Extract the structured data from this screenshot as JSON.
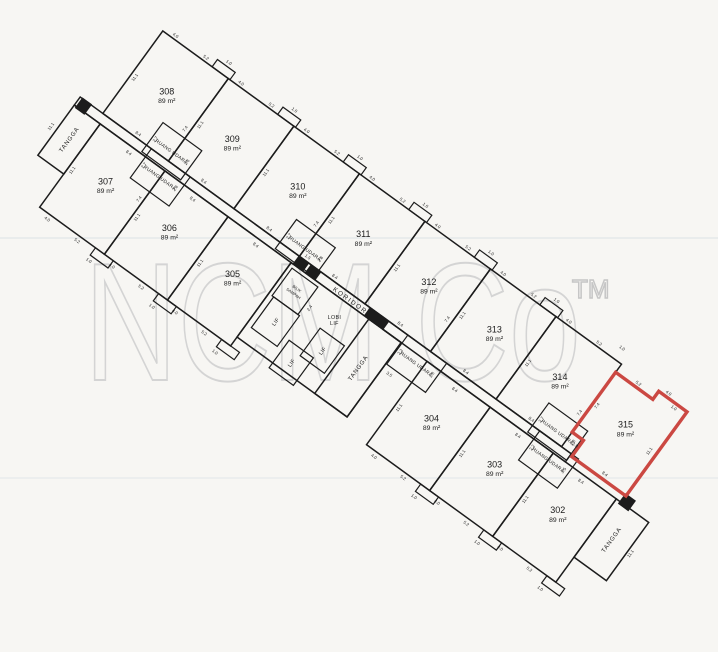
{
  "watermark": {
    "text": "NCM Co",
    "tm": "TM"
  },
  "page": {
    "paper_color": "#f7f6f3",
    "ink_color": "#1c1c1c",
    "highlight_color": "#cb4842",
    "watermark_color": "#d4d4d4"
  },
  "plan": {
    "angle": 36,
    "origin": {
      "x": 145,
      "y": 18
    },
    "corridor": {
      "label": "KORIDOR",
      "x": -6,
      "y": 102,
      "w": 607,
      "h": 10,
      "label_x": 332,
      "label_y": 110
    },
    "row_upper": {
      "y": 0,
      "h": 102
    },
    "row_lower": {
      "y": 112,
      "h": 103
    },
    "upper_units": [
      {
        "num": "308",
        "area": "89 m²",
        "x1": 22,
        "x2": 103
      },
      {
        "num": "309",
        "area": "89 m²",
        "x1": 103,
        "x2": 184
      },
      {
        "num": "310",
        "area": "89 m²",
        "x1": 184,
        "x2": 265
      },
      {
        "num": "311",
        "area": "89 m²",
        "x1": 265,
        "x2": 346
      },
      {
        "num": "312",
        "area": "89 m²",
        "x1": 346,
        "x2": 427
      },
      {
        "num": "313",
        "area": "89 m²",
        "x1": 427,
        "x2": 508
      },
      {
        "num": "314",
        "area": "89 m²",
        "x1": 508,
        "x2": 589
      },
      {
        "num": "315",
        "area": "89 m²",
        "x1": 589,
        "x2": 670,
        "highlight": true,
        "outline": [
          [
            589,
            10
          ],
          [
            635,
            10
          ],
          [
            635,
            0
          ],
          [
            670,
            0
          ],
          [
            670,
            104
          ],
          [
            603,
            104
          ],
          [
            603,
            84
          ],
          [
            589,
            84
          ]
        ]
      }
    ],
    "lower_units": [
      {
        "num": "307",
        "area": "89 m²",
        "x1": 26,
        "x2": 106
      },
      {
        "num": "306",
        "area": "89 m²",
        "x1": 106,
        "x2": 184
      },
      {
        "num": "305",
        "area": "89 m²",
        "x1": 184,
        "x2": 262
      },
      {
        "num": "304",
        "area": "89 m²",
        "x1": 430,
        "x2": 508
      },
      {
        "num": "303",
        "area": "89 m²",
        "x1": 508,
        "x2": 586
      },
      {
        "num": "302",
        "area": "89 m²",
        "x1": 586,
        "x2": 664
      }
    ],
    "stairs": [
      {
        "label": "TANGGA",
        "x": -6,
        "y": 112,
        "w": 32,
        "h": 62
      },
      {
        "label": "TANGGA",
        "x": 358,
        "y": 112,
        "w": 40,
        "h": 92
      },
      {
        "label": "TANGGA",
        "x": 664,
        "y": 112,
        "w": 40,
        "h": 72
      }
    ],
    "core": {
      "x": 262,
      "y": 112,
      "w": 136,
      "h": 92
    },
    "lifts": [
      {
        "label": "LIF",
        "x": 268,
        "y": 150,
        "w": 32,
        "h": 38
      },
      {
        "label": "LIF",
        "x": 324,
        "y": 148,
        "w": 30,
        "h": 34
      },
      {
        "label": "LIF",
        "x": 306,
        "y": 176,
        "w": 30,
        "h": 34
      }
    ],
    "lobby": {
      "line1": "LOBI",
      "line2": "LIF",
      "x": 330,
      "y": 132
    },
    "refuse": {
      "line1": "BILIK",
      "line2": "SAMPAH",
      "x": 266,
      "y": 116,
      "w": 32,
      "h": 34
    },
    "airwells": [
      {
        "label": "RUANG UDARA",
        "x": 76,
        "y": 74,
        "w": 48,
        "h": 36,
        "dims": [
          "2.7",
          "2.8"
        ]
      },
      {
        "label": "RUANG UDARA",
        "x": 82,
        "y": 102,
        "w": 48,
        "h": 36,
        "dims": [
          "2.7",
          "2.8"
        ]
      },
      {
        "label": "RUANG UDARA",
        "x": 241,
        "y": 74,
        "w": 48,
        "h": 36,
        "dims": [
          "2.7",
          "2.8"
        ]
      },
      {
        "label": "RUANG UDARA",
        "x": 399,
        "y": 102,
        "w": 48,
        "h": 36,
        "dims": [
          "2.2",
          "2.8"
        ]
      },
      {
        "label": "RUANG UDARA",
        "x": 553,
        "y": 74,
        "w": 48,
        "h": 36,
        "dims": [
          "2.7",
          "2.8"
        ]
      },
      {
        "label": "RUANG UDARA",
        "x": 562,
        "y": 102,
        "w": 48,
        "h": 36,
        "dims": [
          "2.2",
          "3.5"
        ]
      }
    ],
    "notches": {
      "upper": [
        103,
        184,
        265,
        346,
        427,
        508
      ],
      "lower": [
        106,
        184,
        262,
        508,
        586,
        664
      ]
    },
    "risers": [
      [
        -4,
        101,
        12,
        13
      ],
      [
        264,
        102,
        13,
        10
      ],
      [
        279,
        102,
        13,
        10
      ],
      [
        352,
        102,
        24,
        10
      ],
      [
        668,
        102,
        13,
        13
      ]
    ],
    "dim_labels": {
      "width": "8.4",
      "depth": "11.1",
      "outer_a": "4.0",
      "outer_b": "5.2",
      "outer_c": "1.0"
    },
    "extra_dims": [
      {
        "t": "5.2",
        "x": 614,
        "y": 7,
        "r": 0
      },
      {
        "t": "4.0",
        "x": 644,
        "y": -3,
        "r": 0
      },
      {
        "t": "1.0",
        "x": 657,
        "y": 6,
        "r": 0
      },
      {
        "t": "11.1",
        "x": 664,
        "y": 54,
        "r": 1
      },
      {
        "t": "8.4",
        "x": 640,
        "y": 100,
        "r": 0
      },
      {
        "t": "7.4",
        "x": 595,
        "y": 48,
        "r": 1
      },
      {
        "t": "2.8",
        "x": 599,
        "y": 94,
        "r": 0
      },
      {
        "t": "11.1",
        "x": -11,
        "y": 143,
        "r": 1
      },
      {
        "t": "11.1",
        "x": 709,
        "y": 148,
        "r": 1
      },
      {
        "t": "2.4",
        "x": 305,
        "y": 138,
        "r": 1
      },
      {
        "t": "3.5",
        "x": 407,
        "y": 146,
        "r": 0
      },
      {
        "t": "1.5",
        "x": 272,
        "y": 99,
        "r": 0
      },
      {
        "t": "7.4",
        "x": 99,
        "y": 66,
        "r": 1
      },
      {
        "t": "7.4",
        "x": 261,
        "y": 66,
        "r": 1
      },
      {
        "t": "7.4",
        "x": 423,
        "y": 66,
        "r": 1
      },
      {
        "t": "7.4",
        "x": 585,
        "y": 64,
        "r": 1
      },
      {
        "t": "7.4",
        "x": 103,
        "y": 150,
        "r": 1
      }
    ]
  }
}
